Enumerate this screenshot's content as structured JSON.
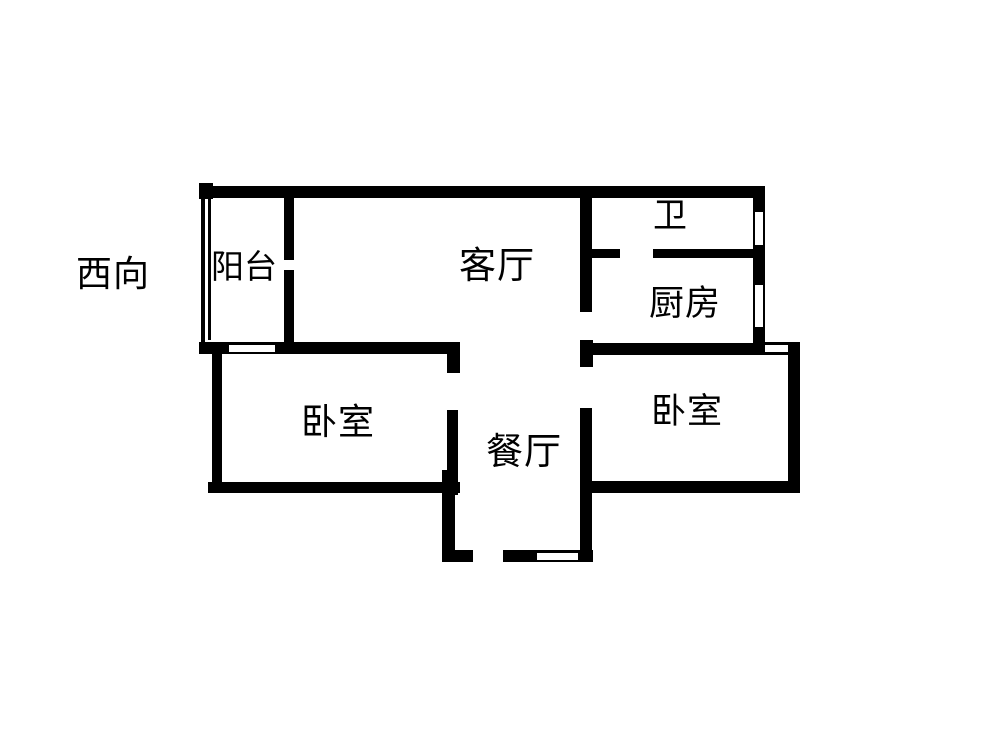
{
  "plan": {
    "type": "apartment-floor-plan",
    "orientation_label": "西向",
    "rooms": {
      "balcony": "阳台",
      "living_room": "客厅",
      "bathroom": "卫",
      "kitchen": "厨房",
      "bedroom_left": "卧室",
      "bedroom_right": "卧室",
      "dining_room": "餐厅"
    }
  },
  "colors": {
    "wall": "#000000",
    "background": "#ffffff",
    "text": "#000000"
  }
}
